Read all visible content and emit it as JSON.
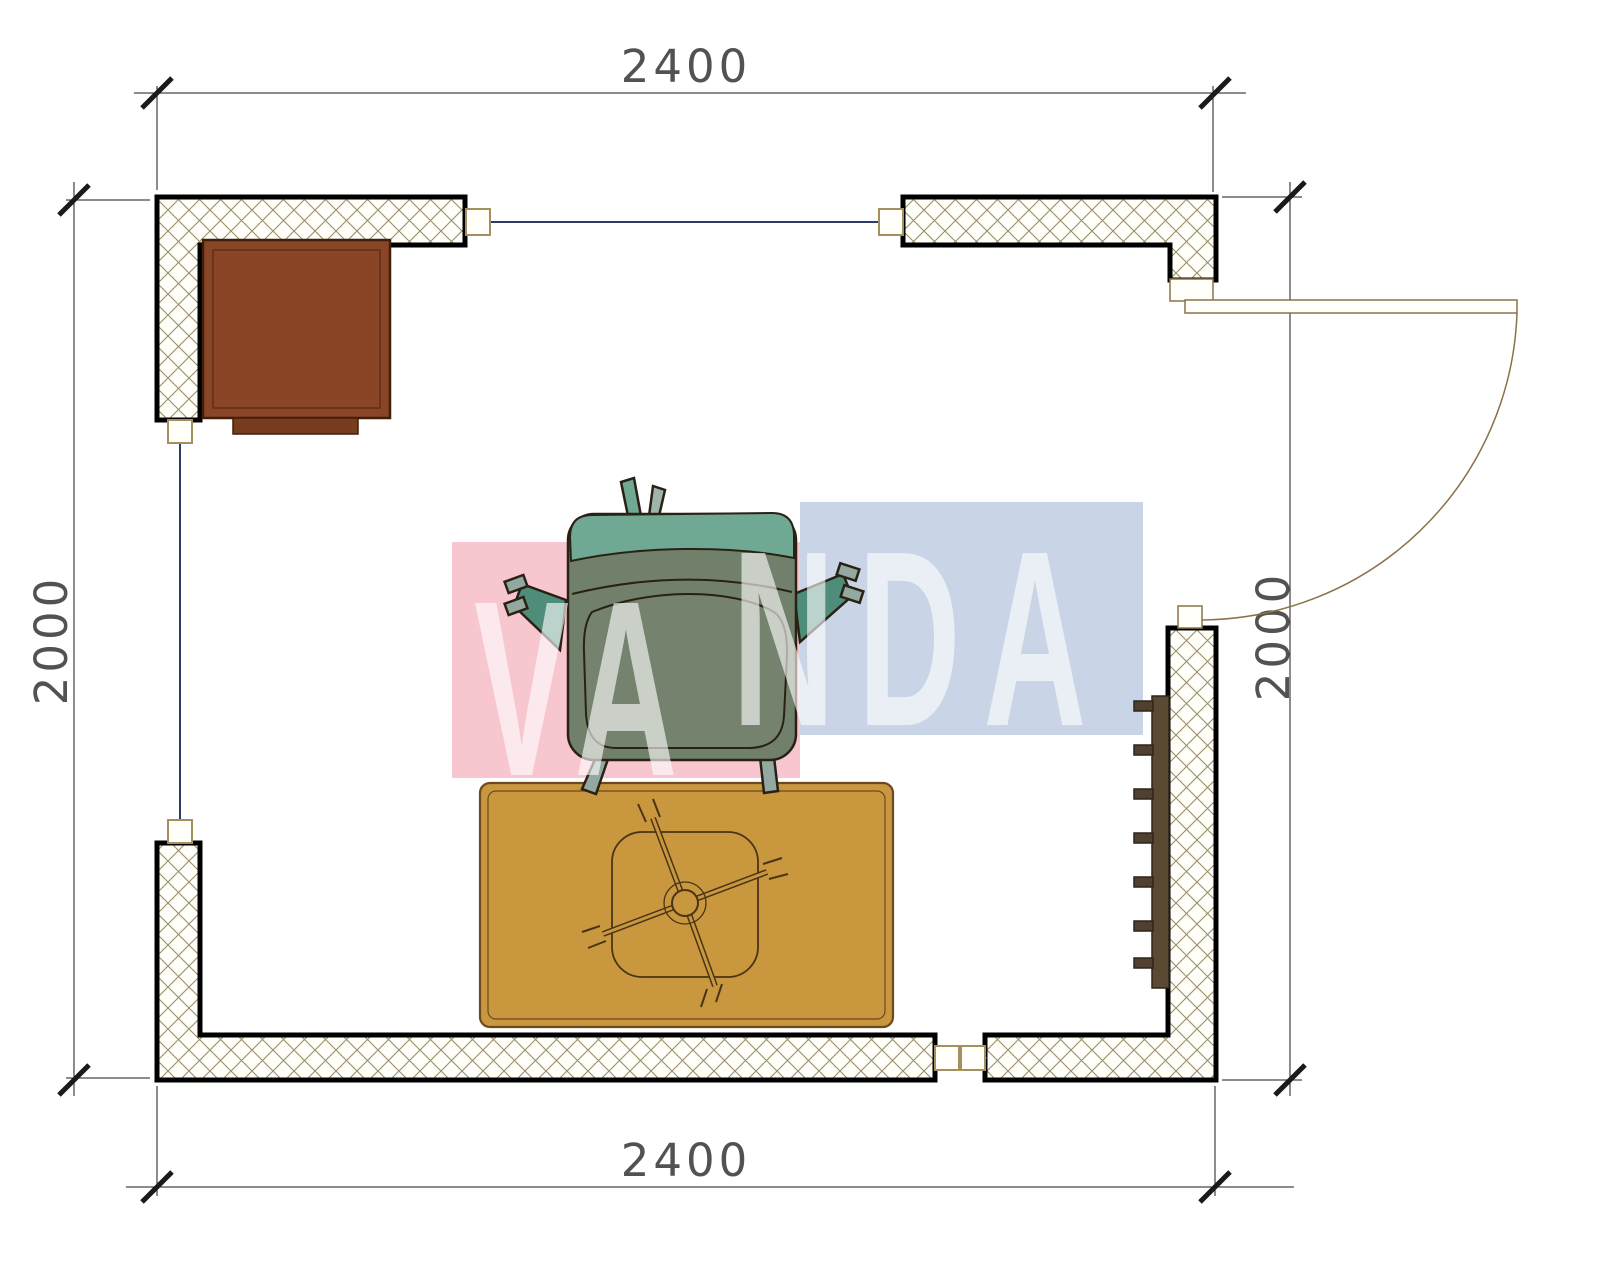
{
  "drawing": {
    "type": "floor-plan",
    "room": {
      "width_label_top": "2400",
      "width_label_bottom": "2400",
      "depth_label_left": "2000",
      "depth_label_right": "2000"
    }
  },
  "dimensions": {
    "top": "2400",
    "bottom": "2400",
    "left": "2000",
    "right": "2000"
  },
  "watermark": {
    "left_text": "VA",
    "right_text": "NDA",
    "pink_block": "#f8c6cf",
    "blue_block": "#c9d4e6",
    "letter_color": "rgba(255,255,255,0.62)"
  },
  "furniture": [
    "cabinet",
    "armchair",
    "rug",
    "coffee-table",
    "radiator",
    "door"
  ],
  "colors": {
    "wall_outline": "#000000",
    "hatch_line": "#9a8e6b",
    "window_line": "#2b3a6b",
    "post_border": "#a3905e",
    "door_line": "#8a7248",
    "cabinet_fill": "#8a4527",
    "cabinet_border": "#3f1f0c",
    "cabinet_tab": "#7a3c1e",
    "rug_fill": "#c9973e",
    "rug_border": "#6b4a1e",
    "table_line": "#4a3416",
    "radiator_bar": "#5b4a33",
    "radiator_fin": "#4f4030",
    "chair_body": "#71806a",
    "chair_back": "#6fa893",
    "chair_arm": "#4e8d7a",
    "chair_leg": "#93a8a0",
    "chair_outline": "#2a2115",
    "dimension_text": "#3a3a3a"
  }
}
